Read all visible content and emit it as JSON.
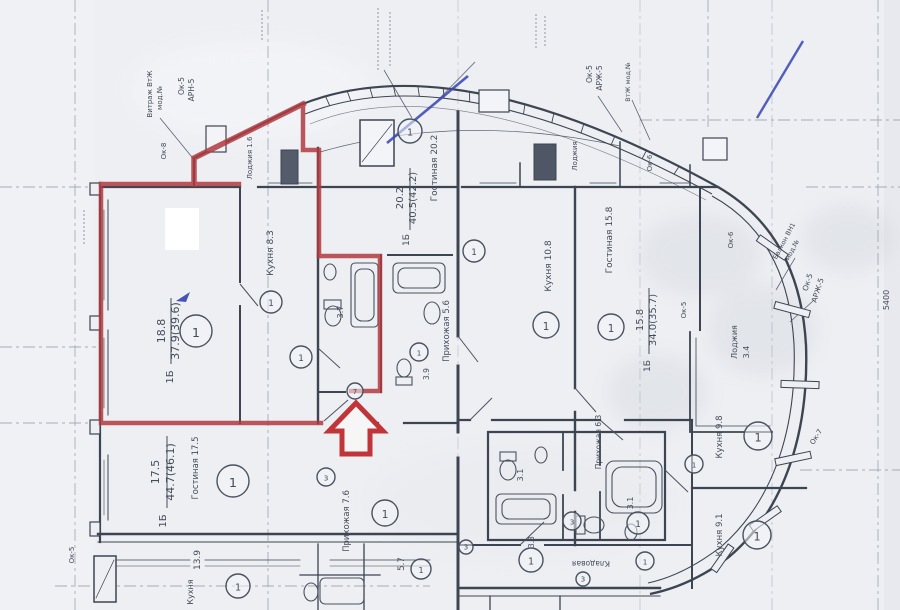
{
  "colors": {
    "paper": "#edeff3",
    "ink": "#49525f",
    "wall": "#3d4553",
    "grid": "#7e8799",
    "highlight_red": "#b03a40",
    "pen_blue": "#3a49b4",
    "watermark": "#9aa0ad"
  },
  "floorplan": {
    "labels": [
      {
        "t": "18.8",
        "x": 165,
        "y": 331,
        "r": -90,
        "fs": 11
      },
      {
        "t": "37.9(39.6)",
        "x": 179,
        "y": 331,
        "r": -90,
        "fs": 11
      },
      {
        "t": "1Б",
        "x": 173,
        "y": 377,
        "r": -90,
        "fs": 10
      },
      {
        "t": "Кухня 8.3",
        "x": 273,
        "y": 253,
        "r": -90,
        "fs": 9
      },
      {
        "t": "20.2",
        "x": 403,
        "y": 198,
        "r": -90,
        "fs": 10
      },
      {
        "t": "40.5(42.2)",
        "x": 416,
        "y": 198,
        "r": -90,
        "fs": 10
      },
      {
        "t": "1Б",
        "x": 409,
        "y": 240,
        "r": -90,
        "fs": 9
      },
      {
        "t": "Гостиная 20.2",
        "x": 437,
        "y": 168,
        "r": -90,
        "fs": 9
      },
      {
        "t": "Прихожая 5.6",
        "x": 449,
        "y": 331,
        "r": -90,
        "fs": 8.5
      },
      {
        "t": "3.7",
        "x": 343,
        "y": 312,
        "r": -90,
        "fs": 8
      },
      {
        "t": "3.9",
        "x": 429,
        "y": 374,
        "r": -90,
        "fs": 7.5
      },
      {
        "t": "Кухня 10.8",
        "x": 551,
        "y": 266,
        "r": -90,
        "fs": 9
      },
      {
        "t": "Гостиная 15.8",
        "x": 612,
        "y": 240,
        "r": -90,
        "fs": 9
      },
      {
        "t": "15.8",
        "x": 643,
        "y": 320,
        "r": -90,
        "fs": 10
      },
      {
        "t": "34.0(35.7)",
        "x": 656,
        "y": 320,
        "r": -90,
        "fs": 10
      },
      {
        "t": "1Б",
        "x": 650,
        "y": 366,
        "r": -90,
        "fs": 9
      },
      {
        "t": "Лоджия",
        "x": 737,
        "y": 342,
        "r": -90,
        "fs": 8
      },
      {
        "t": "3.4",
        "x": 749,
        "y": 352,
        "r": -90,
        "fs": 8
      },
      {
        "t": "Кухня 9.8",
        "x": 722,
        "y": 437,
        "r": -90,
        "fs": 8.5
      },
      {
        "t": "Кухня 9.1",
        "x": 722,
        "y": 535,
        "r": -90,
        "fs": 8.5
      },
      {
        "t": "Прихожая 6.3",
        "x": 601,
        "y": 442,
        "r": -90,
        "fs": 7.5
      },
      {
        "t": "3.1",
        "x": 523,
        "y": 475,
        "r": -90,
        "fs": 8
      },
      {
        "t": "3.1",
        "x": 633,
        "y": 503,
        "r": -90,
        "fs": 8
      },
      {
        "t": "Кладовая",
        "x": 591,
        "y": 561,
        "r": 180,
        "fs": 7.5
      },
      {
        "t": "3.3",
        "x": 534,
        "y": 542,
        "r": -90,
        "fs": 7.5
      },
      {
        "t": "17.5",
        "x": 159,
        "y": 472,
        "r": -90,
        "fs": 11
      },
      {
        "t": "44.7(46.1)",
        "x": 174,
        "y": 472,
        "r": -90,
        "fs": 11
      },
      {
        "t": "1Б",
        "x": 166,
        "y": 521,
        "r": -90,
        "fs": 10
      },
      {
        "t": "Гостиная 17.5",
        "x": 198,
        "y": 468,
        "r": -90,
        "fs": 8.5
      },
      {
        "t": "13.9",
        "x": 200,
        "y": 560,
        "r": -90,
        "fs": 9
      },
      {
        "t": "Кухня",
        "x": 193,
        "y": 592,
        "r": -90,
        "fs": 8
      },
      {
        "t": "Прихожая 7.6",
        "x": 349,
        "y": 521,
        "r": -90,
        "fs": 8.5
      },
      {
        "t": "5.7",
        "x": 404,
        "y": 564,
        "r": -90,
        "fs": 8.5
      },
      {
        "t": "Лоджия 1.6",
        "x": 252,
        "y": 158,
        "r": -90,
        "fs": 7
      },
      {
        "t": "Лоджия",
        "x": 577,
        "y": 156,
        "r": -90,
        "fs": 7
      },
      {
        "t": "Ок-5",
        "x": 592,
        "y": 74,
        "r": -90,
        "fs": 7.5
      },
      {
        "t": "АРЖ-5",
        "x": 602,
        "y": 78,
        "r": -90,
        "fs": 7.5
      },
      {
        "t": "ВтЖ мод.№",
        "x": 630,
        "y": 82,
        "r": -90,
        "fs": 6.5
      },
      {
        "t": "Ок-6",
        "x": 652,
        "y": 163,
        "r": -90,
        "fs": 7
      },
      {
        "t": "Ок-6",
        "x": 733,
        "y": 240,
        "r": -90,
        "fs": 7
      },
      {
        "t": "Ок-5",
        "x": 686,
        "y": 310,
        "r": -90,
        "fs": 7
      },
      {
        "t": "Ок-5",
        "x": 810,
        "y": 283,
        "r": -72,
        "fs": 7.5
      },
      {
        "t": "АРЖ-5",
        "x": 820,
        "y": 291,
        "r": -72,
        "fs": 7.5
      },
      {
        "t": "Ок-7",
        "x": 818,
        "y": 438,
        "r": -58,
        "fs": 7
      },
      {
        "t": "Балкон ВН1",
        "x": 786,
        "y": 242,
        "r": -62,
        "fs": 6.5
      },
      {
        "t": "мод.№",
        "x": 794,
        "y": 251,
        "r": -62,
        "fs": 6.5
      },
      {
        "t": "5400",
        "x": 889,
        "y": 300,
        "r": -90,
        "fs": 8
      },
      {
        "t": "Витраж ВтЖ",
        "x": 152,
        "y": 94,
        "r": -90,
        "fs": 7
      },
      {
        "t": "мод.№",
        "x": 162,
        "y": 98,
        "r": -90,
        "fs": 7
      },
      {
        "t": "Ок-5",
        "x": 184,
        "y": 86,
        "r": -90,
        "fs": 7.5
      },
      {
        "t": "АРН-5",
        "x": 194,
        "y": 90,
        "r": -90,
        "fs": 7.5
      },
      {
        "t": "Ок-8",
        "x": 166,
        "y": 151,
        "r": -90,
        "fs": 7
      },
      {
        "t": "Ок-5",
        "x": 74,
        "y": 555,
        "r": -90,
        "fs": 7
      }
    ],
    "markers": [
      {
        "x": 196,
        "y": 331,
        "rr": 16,
        "t": "1"
      },
      {
        "x": 271,
        "y": 302,
        "rr": 11,
        "t": "1"
      },
      {
        "x": 301,
        "y": 357,
        "rr": 11,
        "t": "1"
      },
      {
        "x": 355,
        "y": 391,
        "rr": 8,
        "t": "7"
      },
      {
        "x": 419,
        "y": 352,
        "rr": 9,
        "t": "1"
      },
      {
        "x": 474,
        "y": 251,
        "rr": 11,
        "t": "1"
      },
      {
        "x": 410,
        "y": 131,
        "rr": 12,
        "t": "1"
      },
      {
        "x": 546,
        "y": 325,
        "rr": 13,
        "t": "1"
      },
      {
        "x": 611,
        "y": 327,
        "rr": 13,
        "t": "1"
      },
      {
        "x": 233,
        "y": 481,
        "rr": 16,
        "t": "1"
      },
      {
        "x": 385,
        "y": 513,
        "rr": 13,
        "t": "1"
      },
      {
        "x": 326,
        "y": 477,
        "rr": 9,
        "t": "3"
      },
      {
        "x": 421,
        "y": 569,
        "rr": 10,
        "t": "1"
      },
      {
        "x": 531,
        "y": 560,
        "rr": 12,
        "t": "1"
      },
      {
        "x": 466,
        "y": 547,
        "rr": 7,
        "t": "3"
      },
      {
        "x": 645,
        "y": 561,
        "rr": 9,
        "t": "1"
      },
      {
        "x": 583,
        "y": 579,
        "rr": 7,
        "t": "3"
      },
      {
        "x": 758,
        "y": 436,
        "rr": 14,
        "t": "1"
      },
      {
        "x": 757,
        "y": 535,
        "rr": 14,
        "t": "1"
      },
      {
        "x": 638,
        "y": 523,
        "rr": 11,
        "t": "1"
      },
      {
        "x": 572,
        "y": 521,
        "rr": 9,
        "t": "3"
      },
      {
        "x": 694,
        "y": 464,
        "rr": 9,
        "t": "1"
      },
      {
        "x": 238,
        "y": 586,
        "rr": 12,
        "t": "1"
      }
    ]
  }
}
